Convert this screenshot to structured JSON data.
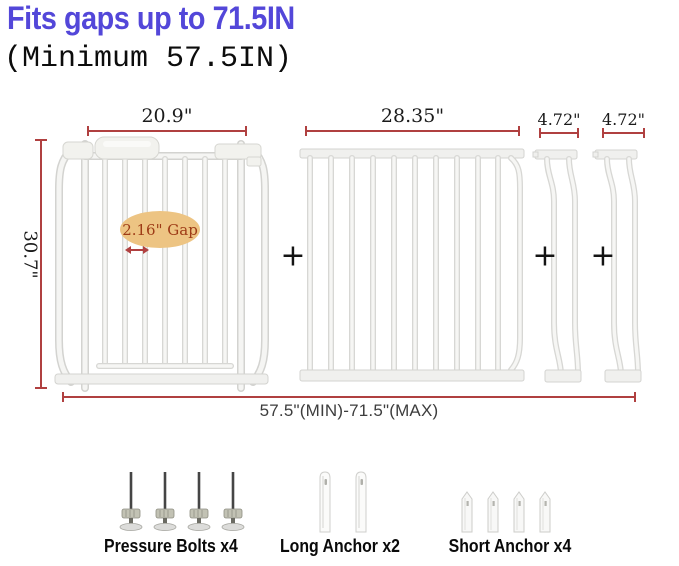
{
  "title": "Fits gaps up to 71.5IN",
  "subtitle": "(Minimum 57.5IN)",
  "dims": {
    "gate": "20.9\"",
    "extension_panel": "28.35\"",
    "small_ext_1": "4.72\"",
    "small_ext_2": "4.72\"",
    "height": "30.7\"",
    "gap_note": "2.16\" Gap",
    "total_range": "57.5\"(MIN)-71.5\"(MAX)"
  },
  "plus_sign": "+",
  "accessories": {
    "pressure_bolts": "Pressure Bolts x4",
    "long_anchor": "Long Anchor x2",
    "short_anchor": "Short Anchor x4"
  },
  "colors": {
    "title_blue": "#5347d9",
    "dimension_red": "#b04040",
    "gap_bubble_bg": "#edc483",
    "gap_text_red": "#9e3b16",
    "gate_white": "#f5f5f3"
  }
}
